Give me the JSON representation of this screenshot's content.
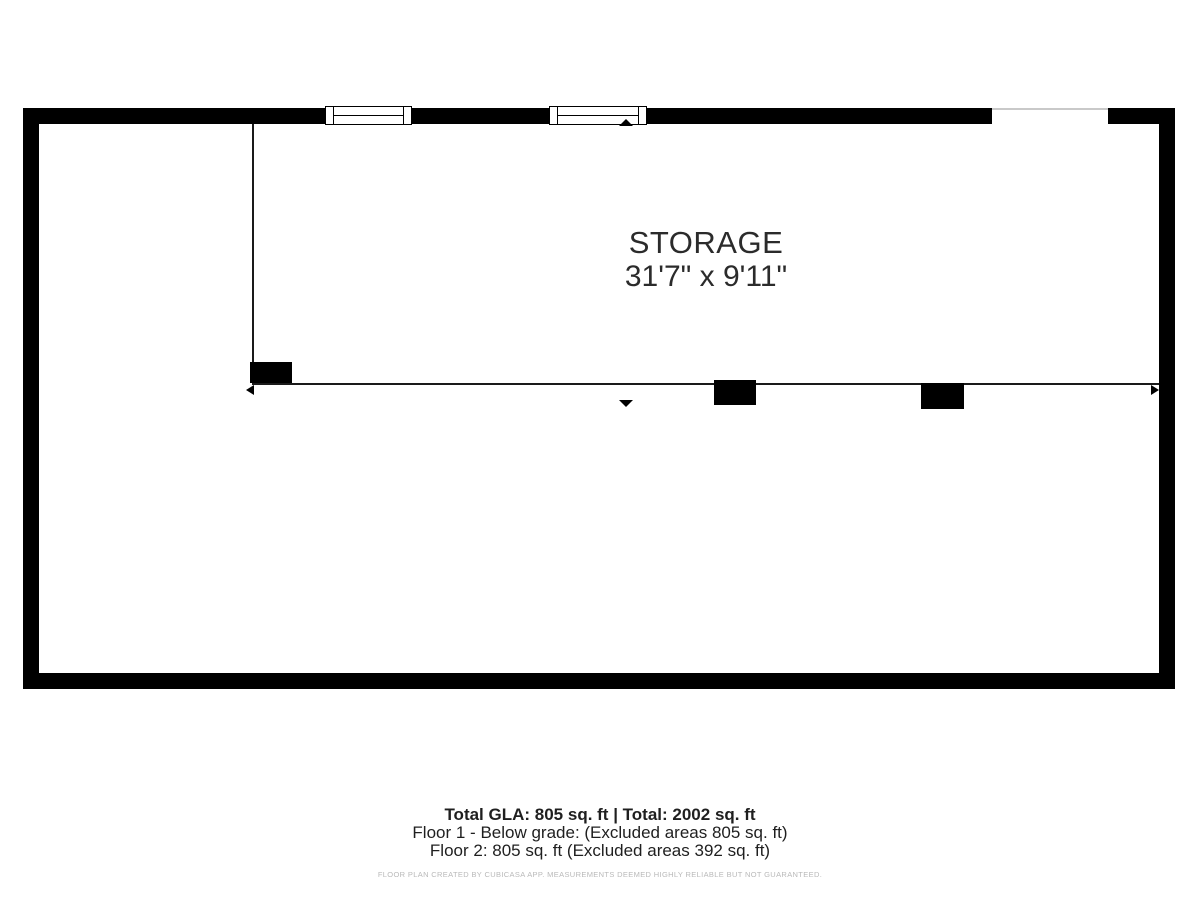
{
  "floor_plan": {
    "room": {
      "label": "STORAGE",
      "dimensions": "31'7\" x 9'11\""
    },
    "summary": {
      "total": "Total GLA: 805 sq. ft | Total: 2002 sq. ft",
      "floor1": "Floor 1 - Below grade: (Excluded areas 805 sq. ft)",
      "floor2": "Floor 2: 805 sq. ft (Excluded areas 392 sq. ft)",
      "disclaimer": "FLOOR PLAN CREATED BY CUBICASA APP. MEASUREMENTS DEEMED HIGHLY RELIABLE BUT NOT GUARANTEED."
    },
    "colors": {
      "wall": "#000000",
      "interior_wall": "#1a1a1a",
      "opening_line": "#c9c9c9",
      "room_text": "#2b2b2b",
      "summary_text": "#1f1f1f",
      "disclaimer_text": "#b9b9b9"
    }
  }
}
